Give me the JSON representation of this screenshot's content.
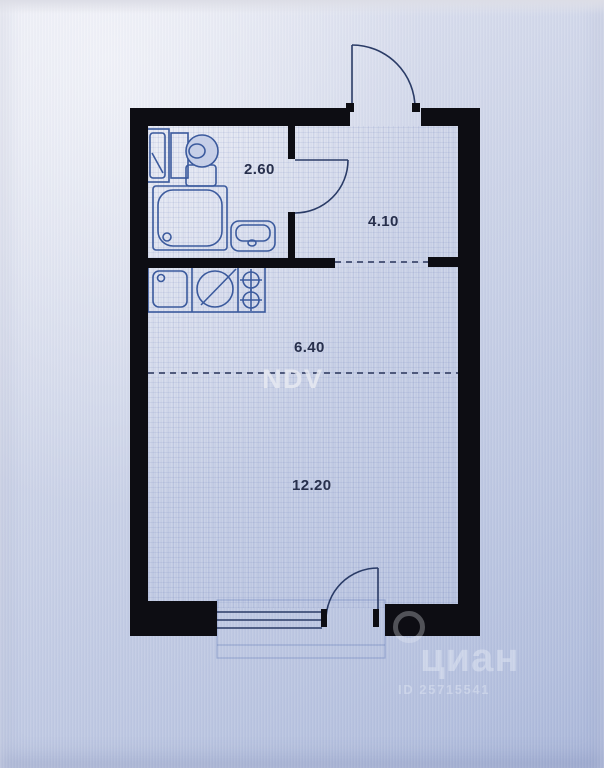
{
  "plan": {
    "type": "studio-apartment-floor-plan",
    "rooms": [
      {
        "id": "bathroom",
        "area_label": "2.60"
      },
      {
        "id": "hallway",
        "area_label": "4.10"
      },
      {
        "id": "kitchen-zone",
        "area_label": "6.40"
      },
      {
        "id": "living-zone",
        "area_label": "12.20"
      }
    ],
    "fixtures": [
      "bathroom-cabinet",
      "toilet",
      "shower-cabin",
      "washbasin",
      "kitchen-sink",
      "round-appliance",
      "hob-2-burner",
      "entrance-door",
      "bathroom-door",
      "balcony-door",
      "window"
    ],
    "watermark_center": "NDV",
    "watermark_brand": "циан",
    "watermark_id": "ID 25715541"
  },
  "colors": {
    "wall": "#0d0d13",
    "line": "#3b5a9d",
    "line-dark": "#2a3b66",
    "label": "#272f4c",
    "paper": "#c6cfe8"
  }
}
